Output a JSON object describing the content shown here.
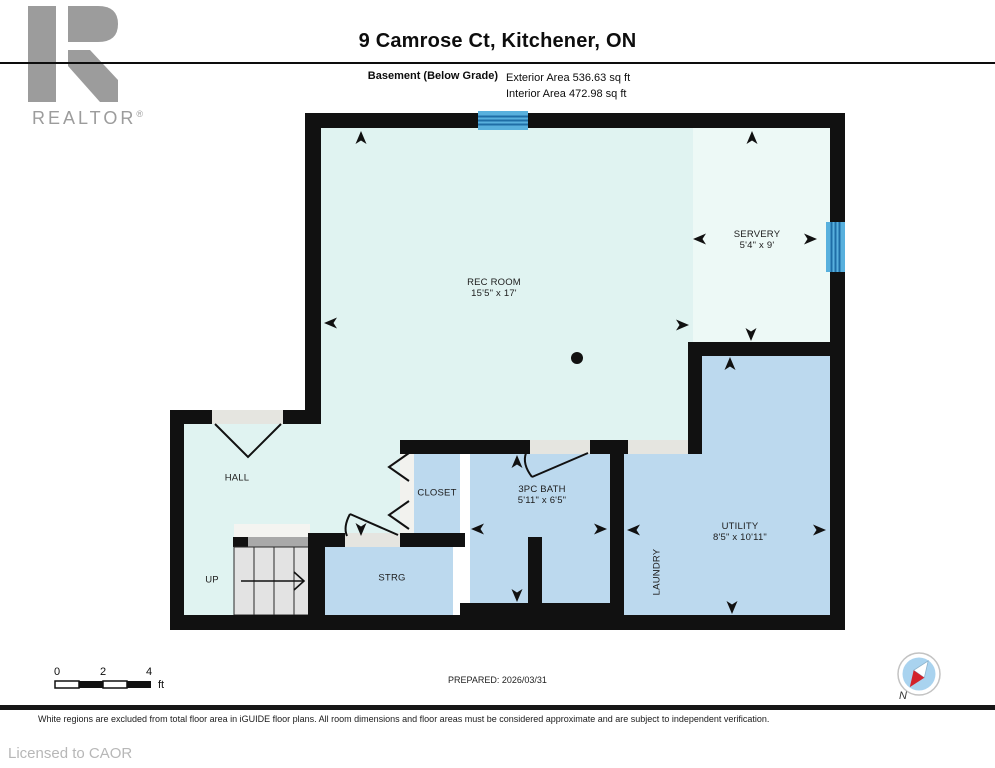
{
  "header": {
    "brand": "REALTOR",
    "registered": "®",
    "title": "9 Camrose Ct, Kitchener, ON",
    "floor_label": "Basement (Below Grade)",
    "exterior_area": "Exterior Area 536.63 sq ft",
    "interior_area": "Interior Area 472.98 sq ft"
  },
  "plan": {
    "rooms": [
      {
        "id": "rec-room",
        "name": "REC ROOM",
        "dims": "15'5\" x 17'"
      },
      {
        "id": "servery",
        "name": "SERVERY",
        "dims": "5'4\" x 9'"
      },
      {
        "id": "hall",
        "name": "HALL",
        "dims": ""
      },
      {
        "id": "closet",
        "name": "CLOSET",
        "dims": ""
      },
      {
        "id": "bath",
        "name": "3PC BATH",
        "dims": "5'11\" x 6'5\""
      },
      {
        "id": "storage",
        "name": "STRG",
        "dims": ""
      },
      {
        "id": "stairs",
        "name": "UP",
        "dims": ""
      },
      {
        "id": "laundry",
        "name": "LAUNDRY",
        "dims": ""
      },
      {
        "id": "utility",
        "name": "UTILITY",
        "dims": "8'5\" x 10'11\""
      }
    ]
  },
  "footer": {
    "scale": {
      "t0": "0",
      "t2": "2",
      "t4": "4",
      "unit": "ft"
    },
    "prepared": "PREPARED: 2026/03/31",
    "compass_n": "N",
    "disclaimer": "White regions are excluded from total floor area in iGUIDE floor plans. All room dimensions and floor areas must be considered approximate and are subject to independent verification.",
    "license": "Licensed to CAOR"
  },
  "colors": {
    "wall": "#111111",
    "open_room_fill": "#e0f3f1",
    "servery_fill": "#edf9f6",
    "blue_room_fill": "#bcd9ee",
    "window_blue": "#58b0dd",
    "window_stripe": "#1f6ea6",
    "stairs_gray": "#e3e3e3",
    "logo_gray": "#9c9c9c",
    "compass_fill": "#a9d3ef",
    "compass_red": "#d3222a"
  }
}
